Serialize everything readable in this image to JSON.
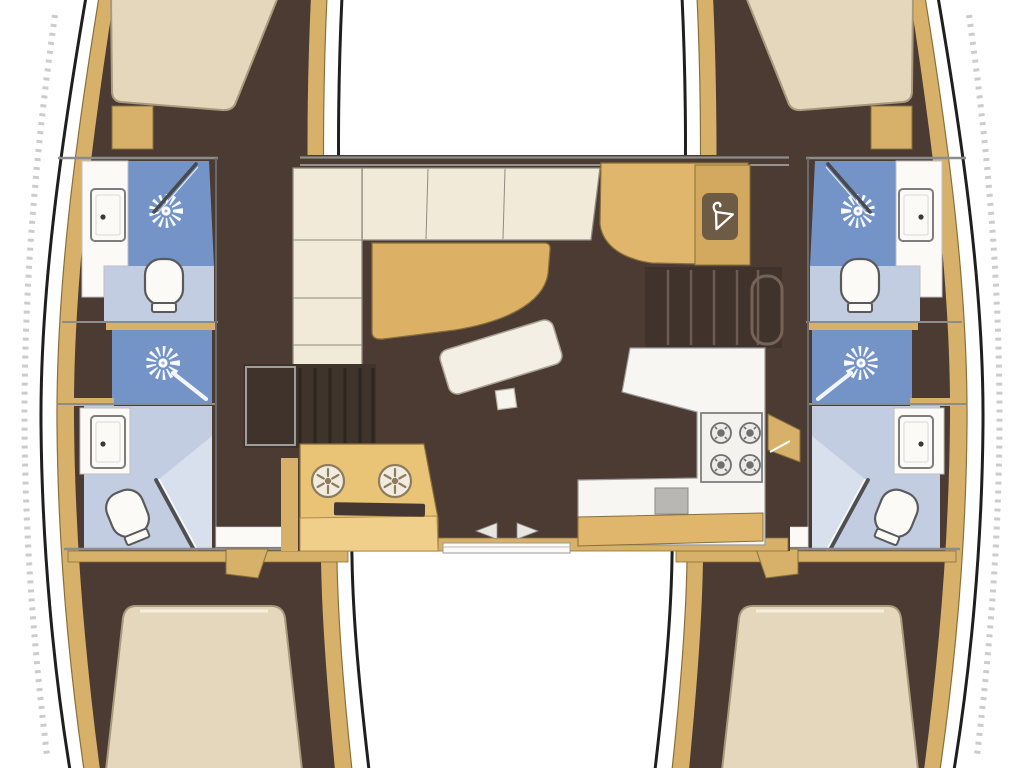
{
  "image": {
    "type": "yacht-floorplan",
    "vessel": "catamaran",
    "view": "top-down-deck-plan"
  },
  "colors": {
    "background": "#ffffff",
    "hull_outline": "#1f1f1f",
    "artifact_gray": "#c3c3c3",
    "deck": "#ffffff",
    "wall_tan": "#d7b169",
    "wall_tan_dark": "#8a6f3a",
    "floor_brown": "#4b3b33",
    "stairs_brown": "#3f332c",
    "stair_line_dark": "#2e2521",
    "stair_line_light": "#6d5c52",
    "bed_cream": "#e5d7bc",
    "bed_border": "#a99a7e",
    "bed_highlight": "#f6efe0",
    "sofa_cream": "#f1ead9",
    "sofa_border": "#8f8b80",
    "table_tan": "#dcb166",
    "ottoman_white": "#f3efe4",
    "shower_blue": "#7494c8",
    "bath_floor_blue": "#c2cde2",
    "glass_blue": "#dce2ee",
    "fixture_white": "#fbfaf7",
    "fixture_border": "#5a5a5a",
    "counter_white": "#f7f6f2",
    "console_tan": "#e9c376",
    "console_front_tan": "#efcf8a",
    "icon_panel_tan": "#d2a95e",
    "icon_square_brown": "#6e5b46",
    "slot_brown": "#443630",
    "stove_gray": "#6f6f6f",
    "sink_gray": "#b9b7b3",
    "line_gray": "#8c8c8c",
    "arrow_gray": "#e8e6e0"
  },
  "icons": [
    {
      "name": "shower-head-icon",
      "glyph": "white sunburst spray"
    },
    {
      "name": "toilet-icon",
      "glyph": "rounded seat with base"
    },
    {
      "name": "sink-icon",
      "glyph": "rounded rectangle basin with drain dot"
    },
    {
      "name": "stove-burner-icon",
      "glyph": "circle with center ring"
    },
    {
      "name": "galley-burner-icon",
      "glyph": "circle with six spokes"
    },
    {
      "name": "hanging-locker-icon",
      "glyph": "coat hanger in rounded square"
    },
    {
      "name": "sliding-door-arrow-left",
      "glyph": "left triangle"
    },
    {
      "name": "sliding-door-arrow-right",
      "glyph": "right triangle"
    }
  ],
  "features": {
    "hulls": 2,
    "rooms": [
      "port-forward-cabin",
      "port-forward-head",
      "port-midship-shower",
      "port-aft-head",
      "port-aft-cabin",
      "starboard-forward-cabin",
      "starboard-forward-head",
      "starboard-midship-shower",
      "starboard-aft-head",
      "starboard-aft-cabin",
      "salon"
    ],
    "salon_items": [
      "l-shaped-sofa",
      "dining-table",
      "ottoman",
      "nav-desk",
      "hanging-locker",
      "port-companionway-stairs",
      "starboard-companionway-stairs",
      "galley-sink-console",
      "galley-counter",
      "four-burner-stove",
      "sliding-door-track"
    ],
    "counts": {
      "berths": 4,
      "heads": 4,
      "shower_stalls": 4,
      "toilets": 4,
      "bath_sinks": 4,
      "stove_burners": 4,
      "galley_burners": 2
    }
  }
}
